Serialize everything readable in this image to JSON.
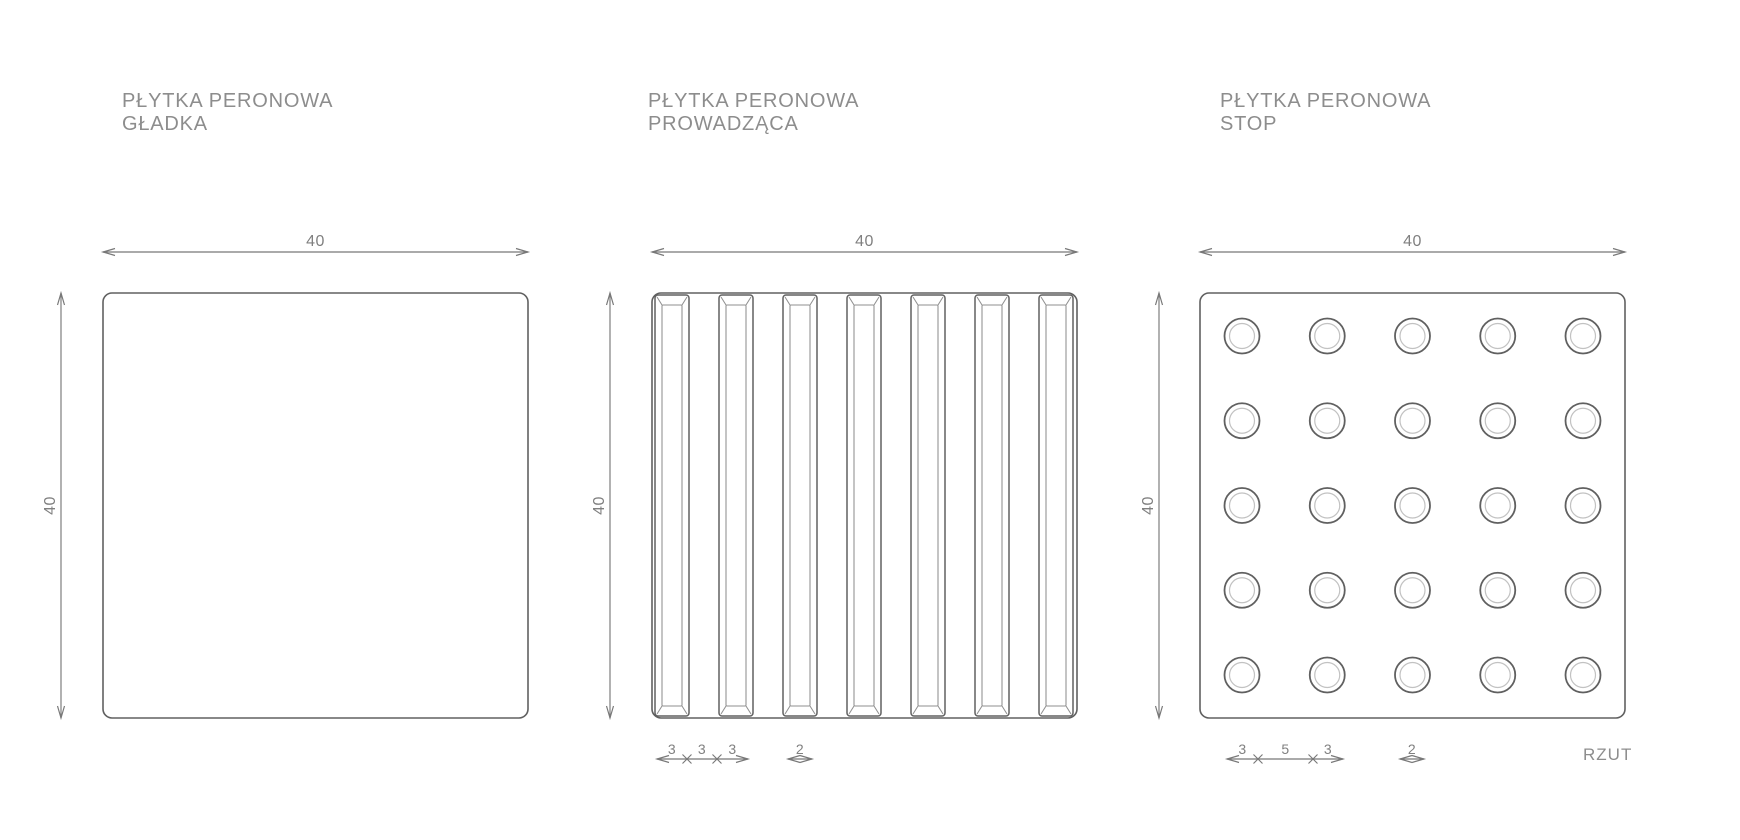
{
  "colors": {
    "background": "#ffffff",
    "outline": "#606060",
    "inner_line": "#8f8f8f",
    "faint_line": "#c2c2c2",
    "dim_line": "#787878",
    "dim_text": "#808080",
    "title_text": "#8d8d8d"
  },
  "titles": [
    {
      "line1": "PŁYTKA PERONOWA",
      "line2": "GŁADKA"
    },
    {
      "line1": "PŁYTKA PERONOWA",
      "line2": "PROWADZĄCA"
    },
    {
      "line1": "PŁYTKA PERONOWA",
      "line2": "STOP"
    }
  ],
  "view_label": "RZUT",
  "drawing": {
    "canvas": {
      "width": 1740,
      "height": 840
    },
    "tiles": [
      {
        "name": "gladka",
        "pattern": "smooth",
        "x": 103,
        "y": 293,
        "size": 425,
        "corner_radius": 9,
        "dim_top": {
          "label": "40",
          "y": 252
        },
        "dim_left": {
          "label": "40",
          "x": 61
        }
      },
      {
        "name": "prowadzaca",
        "pattern": "stripes",
        "x": 652,
        "y": 293,
        "size": 425,
        "corner_radius": 9,
        "dim_top": {
          "label": "40",
          "y": 252
        },
        "dim_left": {
          "label": "40",
          "x": 610
        },
        "stripes": {
          "count": 7,
          "first_x": 655,
          "width": 34,
          "pitch": 64,
          "top": 295,
          "height": 421,
          "side_inset": 7,
          "end_inset": 10
        },
        "dim_segments": {
          "y": 759,
          "start": 657,
          "ticks": [
            687,
            717
          ],
          "end": 748,
          "labels": [
            "3",
            "3",
            "3"
          ]
        },
        "dim_double": {
          "y": 759,
          "center": 800,
          "half_span": 12,
          "label": "2"
        }
      },
      {
        "name": "stop",
        "pattern": "dots",
        "x": 1200,
        "y": 293,
        "size": 425,
        "corner_radius": 9,
        "dim_top": {
          "label": "40",
          "y": 252
        },
        "dim_left": {
          "label": "40",
          "x": 1159
        },
        "dots": {
          "rows": 5,
          "cols": 5,
          "first_cx": 1242,
          "first_cy": 336,
          "pitch_x": 85.25,
          "pitch_y": 84.75,
          "outer_r": 17.5,
          "inner_r": 12.5
        },
        "dim_segments": {
          "y": 759,
          "start": 1227,
          "ticks": [
            1258,
            1313
          ],
          "end": 1343,
          "labels": [
            "3",
            "5",
            "3"
          ]
        },
        "dim_double": {
          "y": 759,
          "center": 1412,
          "half_span": 12,
          "label": "2"
        }
      }
    ]
  }
}
